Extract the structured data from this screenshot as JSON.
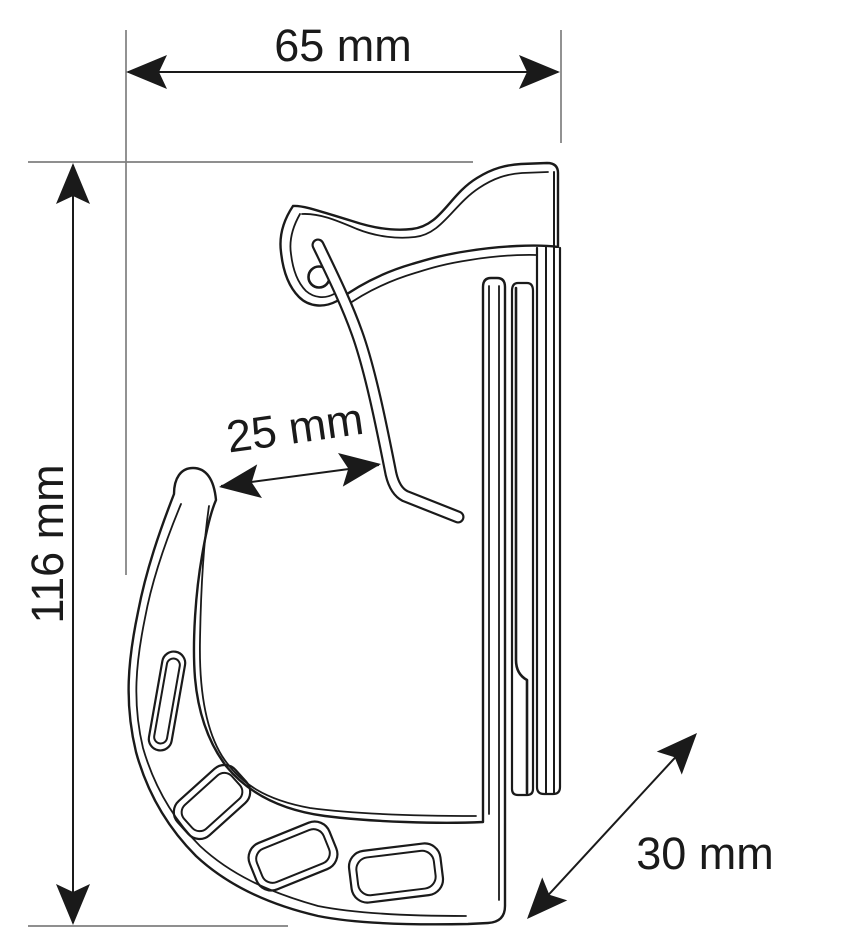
{
  "drawing": {
    "background_color": "#ffffff",
    "line_color": "#1a1a1a",
    "extension_line_color": "#7f7f7f"
  },
  "dimensions": {
    "width": {
      "label": "65 mm"
    },
    "height": {
      "label": "116 mm"
    },
    "hook_gap": {
      "label": "25 mm"
    },
    "depth": {
      "label": "30 mm"
    }
  }
}
